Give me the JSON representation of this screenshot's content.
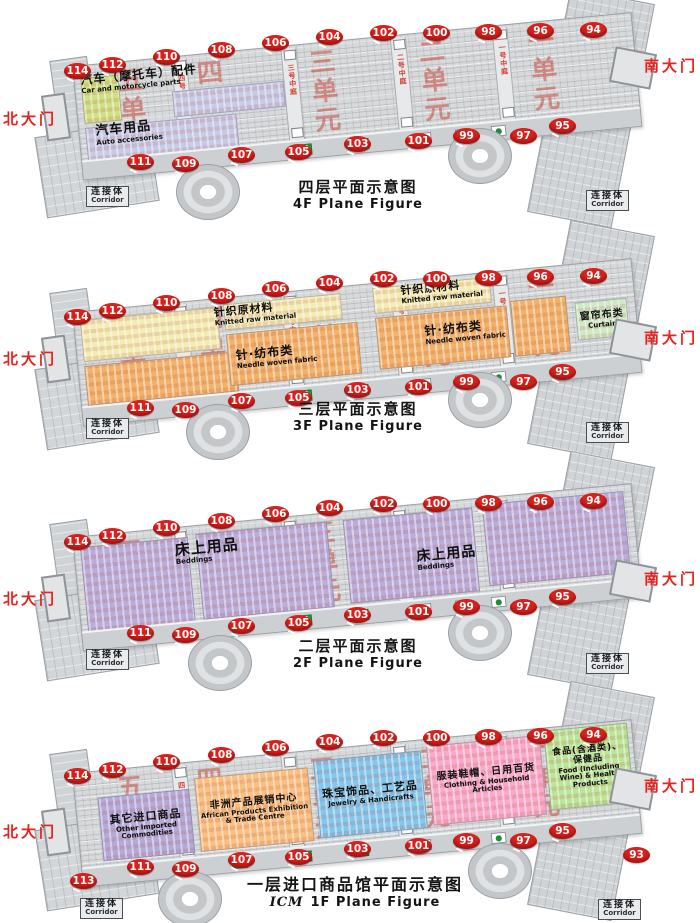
{
  "concourse_icons": [
    "escalator-icon",
    "escalator-icon",
    "escalator-icon",
    "bank-logo-red-icon",
    "bank-logo-c-icon",
    "bank-logo-green-icon"
  ],
  "colors": {
    "gate_badge": "#d8211c",
    "gate_text": "#e8221c",
    "unit_text": "#ca3c2e"
  },
  "floors": [
    {
      "id": "4F",
      "title_zh": "四层平面示意图",
      "title_en_prefix": "",
      "title_en": "4F Plane Figure",
      "north_gate": "北大门",
      "south_gate": "南大门",
      "corridor_zh": "连接体",
      "corridor_en": "Corridor",
      "units": [
        "五单元",
        "四单元",
        "三单元",
        "二单元",
        "一单元"
      ],
      "atriums": [
        "四号中庭",
        "三号中庭",
        "二号中庭",
        "一号中庭"
      ],
      "gates_top": [
        "114",
        "112",
        "110",
        "108",
        "106",
        "104",
        "102",
        "100",
        "98",
        "96",
        "94"
      ],
      "gates_bottom": [
        "111",
        "109",
        "107",
        "105",
        "103",
        "101",
        "99",
        "97",
        "95"
      ],
      "areas": [
        {
          "zh": "汽车（摩托车）配件",
          "en": "Car and motorcycle parts",
          "color": "#cfe183"
        },
        {
          "zh": "汽车用品",
          "en": "Auto accessories",
          "color": "#c6cbe8"
        }
      ]
    },
    {
      "id": "3F",
      "title_zh": "三层平面示意图",
      "title_en_prefix": "",
      "title_en": "3F Plane Figure",
      "north_gate": "北大门",
      "south_gate": "南大门",
      "corridor_zh": "连接体",
      "corridor_en": "Corridor",
      "units": [
        "五单元",
        "四单元",
        "三单元",
        "二单元",
        "一单元"
      ],
      "atriums": [
        "四号中庭",
        "三号中庭",
        "二号中庭",
        "一号中庭"
      ],
      "gates_top": [
        "114",
        "112",
        "110",
        "108",
        "106",
        "104",
        "102",
        "100",
        "98",
        "96",
        "94"
      ],
      "gates_bottom": [
        "111",
        "109",
        "107",
        "105",
        "103",
        "101",
        "99",
        "97",
        "95"
      ],
      "areas": [
        {
          "zh": "针织原材料",
          "en": "Knitted raw material",
          "color": "#f3edb4"
        },
        {
          "zh": "针·纺布类",
          "en": "Needle woven fabric",
          "color": "#f2b269"
        },
        {
          "zh": "窗帘布类",
          "en": "Curtain",
          "color": "#cde9c6"
        }
      ]
    },
    {
      "id": "2F",
      "title_zh": "二层平面示意图",
      "title_en_prefix": "",
      "title_en": "2F Plane Figure",
      "north_gate": "北大门",
      "south_gate": "南大门",
      "corridor_zh": "连接体",
      "corridor_en": "Corridor",
      "units": [
        "五单元",
        "四单元",
        "三单元",
        "二单元",
        "一单元"
      ],
      "atriums": [
        "四号中庭",
        "三号中庭",
        "二号中庭",
        "一号中庭"
      ],
      "gates_top": [
        "114",
        "112",
        "110",
        "108",
        "106",
        "104",
        "102",
        "100",
        "98",
        "96",
        "94"
      ],
      "gates_bottom": [
        "111",
        "109",
        "107",
        "105",
        "103",
        "101",
        "99",
        "97",
        "95"
      ],
      "areas": [
        {
          "zh": "床上用品",
          "en": "Beddings",
          "color": "#b9addb"
        }
      ]
    },
    {
      "id": "1F",
      "title_zh": "一层进口商品馆平面示意图",
      "title_en_prefix": "ICM",
      "title_en": "1F Plane Figure",
      "north_gate": "北大门",
      "south_gate": "南大门",
      "corridor_zh": "连接体",
      "corridor_en": "Corridor",
      "units": [
        "五单元",
        "四单元",
        "三单元",
        "二单元",
        "一单元"
      ],
      "atriums": [
        "四号中庭",
        "三号中庭",
        "二号中庭",
        "一号中庭"
      ],
      "gates_top": [
        "114",
        "112",
        "110",
        "108",
        "106",
        "104",
        "102",
        "100",
        "98",
        "96",
        "94"
      ],
      "gates_bottom": [
        "113",
        "111",
        "109",
        "107",
        "105",
        "103",
        "101",
        "99",
        "97",
        "95",
        "93"
      ],
      "areas": [
        {
          "zh": "其它进口商品",
          "en": "Other Imported Commodities",
          "color": "#b3aada"
        },
        {
          "zh": "非洲产品展销中心",
          "en": "African Products Exhibition & Trade Centre",
          "color": "#f9c081"
        },
        {
          "zh": "珠宝饰品、工艺品",
          "en": "Jewelry & Handicrafts",
          "color": "#82c7ee"
        },
        {
          "zh": "服装鞋帽、日用百货",
          "en": "Clothing & Household Articles",
          "color": "#f9aacb"
        },
        {
          "zh": "食品(含酒类)、保健品",
          "en": "Food (Including Wine) & Health Products",
          "color": "#b9e698"
        }
      ]
    }
  ]
}
